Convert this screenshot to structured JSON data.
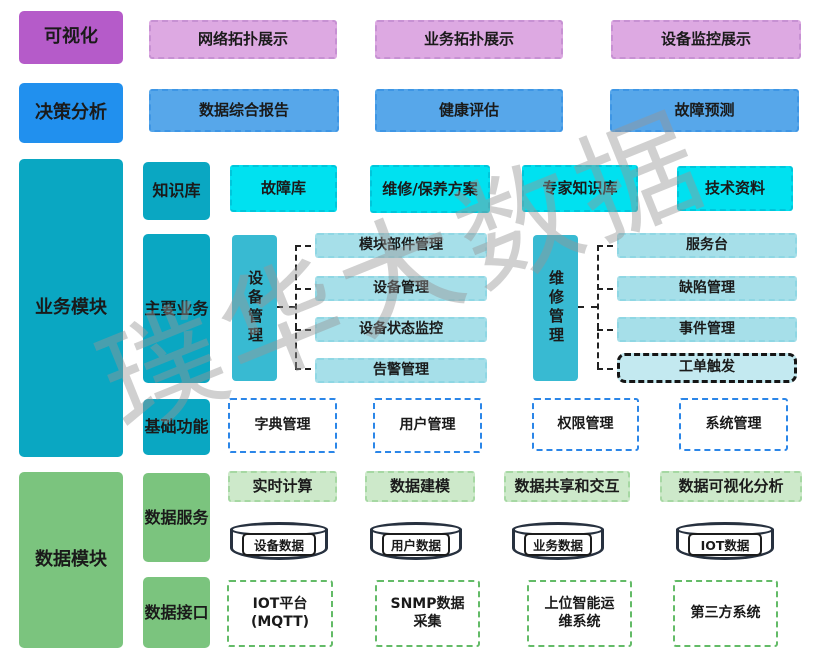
{
  "watermark": "璞华大数据",
  "layers": {
    "visualization": {
      "label": "可视化",
      "items": [
        "网络拓扑展示",
        "业务拓扑展示",
        "设备监控展示"
      ]
    },
    "decision": {
      "label": "决策分析",
      "items": [
        "数据综合报告",
        "健康评估",
        "故障预测"
      ]
    },
    "business": {
      "label": "业务模块",
      "knowledge": {
        "label": "知识库",
        "items": [
          "故障库",
          "维修/保养方案",
          "专家知识库",
          "技术资料"
        ]
      },
      "main_business": {
        "label": "主要业务",
        "device_mgmt": {
          "label": "设备管理",
          "items": [
            "模块部件管理",
            "设备管理",
            "设备状态监控",
            "告警管理"
          ]
        },
        "repair_mgmt": {
          "label": "维修管理",
          "items": [
            "服务台",
            "缺陷管理",
            "事件管理",
            "工单触发"
          ]
        }
      },
      "basic_functions": {
        "label": "基础功能",
        "items": [
          "字典管理",
          "用户管理",
          "权限管理",
          "系统管理"
        ]
      }
    },
    "data": {
      "label": "数据模块",
      "data_service": {
        "label": "数据服务",
        "capabilities": [
          "实时计算",
          "数据建模",
          "数据共享和交互",
          "数据可视化分析"
        ],
        "databases": [
          "设备数据",
          "用户数据",
          "业务数据",
          "IOT数据"
        ]
      },
      "data_interface": {
        "label": "数据接口",
        "items": [
          "IOT平台\n(MQTT)",
          "SNMP数据采集",
          "上位智能运维系统",
          "第三方系统"
        ]
      }
    }
  },
  "colors": {
    "purple_solid": "#b55bc9",
    "purple_light": "#dda9e2",
    "blue_solid": "#2190ee",
    "blue_light": "#57a7ea",
    "teal_solid": "#0aa7c2",
    "teal_mid": "#38bad2",
    "cyan_bright": "#00e1f0",
    "cyan_pale": "#a6dfe9",
    "ticket_fill": "#c3e9f0",
    "green_solid": "#7bc47e",
    "green_pale": "#cde9ca",
    "cylinder_border": "#27313f",
    "connector": "#222222"
  }
}
